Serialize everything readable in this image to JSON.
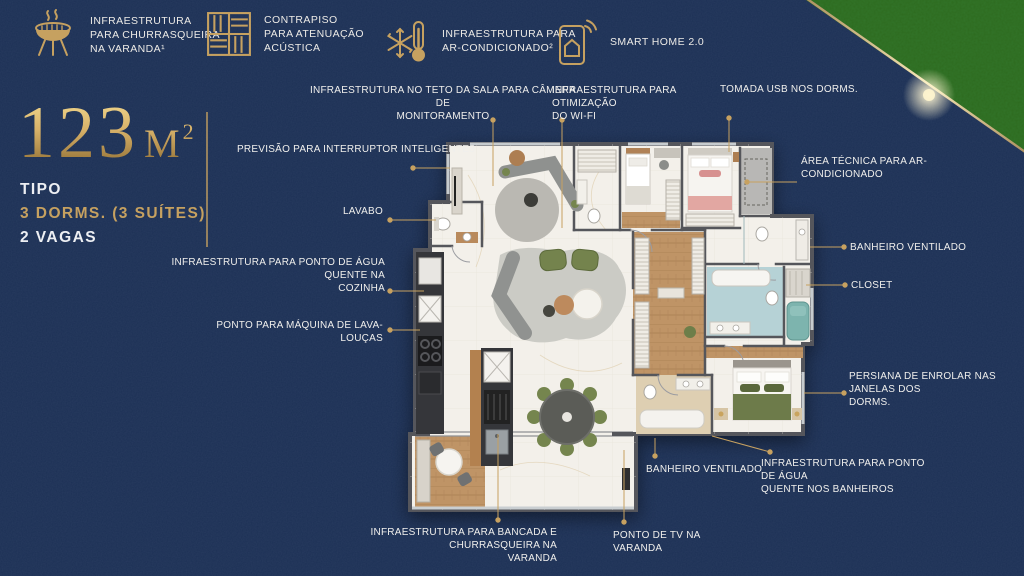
{
  "theme": {
    "background_navy": "#1c3055",
    "gold_accent": "#c6a160",
    "text_white": "#f0efec",
    "corner_grass_green": "#2d6a1e",
    "plan_wall_gray": "#55565b",
    "plan_floor_white": "#f3f0ea",
    "plan_wood": "#bf9466",
    "plan_bath_blue": "#b6d2d6",
    "plan_bath_beige": "#decfb2"
  },
  "features": [
    {
      "icon": "grill-icon",
      "lines": [
        "INFRAESTRUTURA",
        "PARA CHURRASQUEIRA",
        "NA VARANDA¹"
      ]
    },
    {
      "icon": "tiles-icon",
      "lines": [
        "CONTRAPISO",
        "PARA ATENUAÇÃO",
        "ACÚSTICA"
      ]
    },
    {
      "icon": "ac-icon",
      "lines": [
        "INFRAESTRUTURA PARA",
        "AR-CONDICIONADO²"
      ]
    },
    {
      "icon": "smarthome-icon",
      "lines": [
        "SMART HOME 2.0"
      ]
    }
  ],
  "title": {
    "number": "123",
    "unit_base": "M",
    "unit_sup": "2",
    "line1": "TIPO",
    "line2": "3 DORMS. (3 SUÍTES)",
    "line3": "2 VAGAS"
  },
  "callouts": [
    {
      "id": "camera",
      "lines": [
        "INFRAESTRUTURA NO TETO DA SALA PARA CÂMERA DE",
        "MONITORAMENTO"
      ]
    },
    {
      "id": "wifi",
      "lines": [
        "INFRAESTRUTURA PARA OTIMIZAÇÃO",
        "DO WI-FI"
      ]
    },
    {
      "id": "tomada-usb",
      "lines": [
        "TOMADA USB NOS DORMS."
      ]
    },
    {
      "id": "area-tecnica",
      "lines": [
        "ÁREA TÉCNICA PARA AR-",
        "CONDICIONADO"
      ]
    },
    {
      "id": "banheiro-dir",
      "lines": [
        "BANHEIRO VENTILADO"
      ]
    },
    {
      "id": "closet",
      "lines": [
        "CLOSET"
      ]
    },
    {
      "id": "persiana",
      "lines": [
        "PERSIANA DE ENROLAR NAS JANELAS DOS",
        "DORMS."
      ]
    },
    {
      "id": "agua-banheiros",
      "lines": [
        "INFRAESTRUTURA PARA PONTO DE ÁGUA",
        "QUENTE NOS BANHEIROS"
      ]
    },
    {
      "id": "banheiro-baixo",
      "lines": [
        "BANHEIRO VENTILADO"
      ]
    },
    {
      "id": "ponto-tv",
      "lines": [
        "PONTO DE TV NA",
        "VARANDA"
      ]
    },
    {
      "id": "bancada",
      "lines": [
        "INFRAESTRUTURA PARA BANCADA E CHURRASQUEIRA NA",
        "VARANDA"
      ]
    },
    {
      "id": "interruptor",
      "lines": [
        "PREVISÃO PARA INTERRUPTOR INTELIGENTE3"
      ]
    },
    {
      "id": "lavabo",
      "lines": [
        "LAVABO"
      ]
    },
    {
      "id": "agua-cozinha",
      "lines": [
        "INFRAESTRUTURA PARA PONTO DE ÁGUA QUENTE NA",
        "COZINHA"
      ]
    },
    {
      "id": "lava-loucas",
      "lines": [
        "PONTO PARA MÁQUINA DE LAVA-LOUÇAS"
      ]
    }
  ]
}
